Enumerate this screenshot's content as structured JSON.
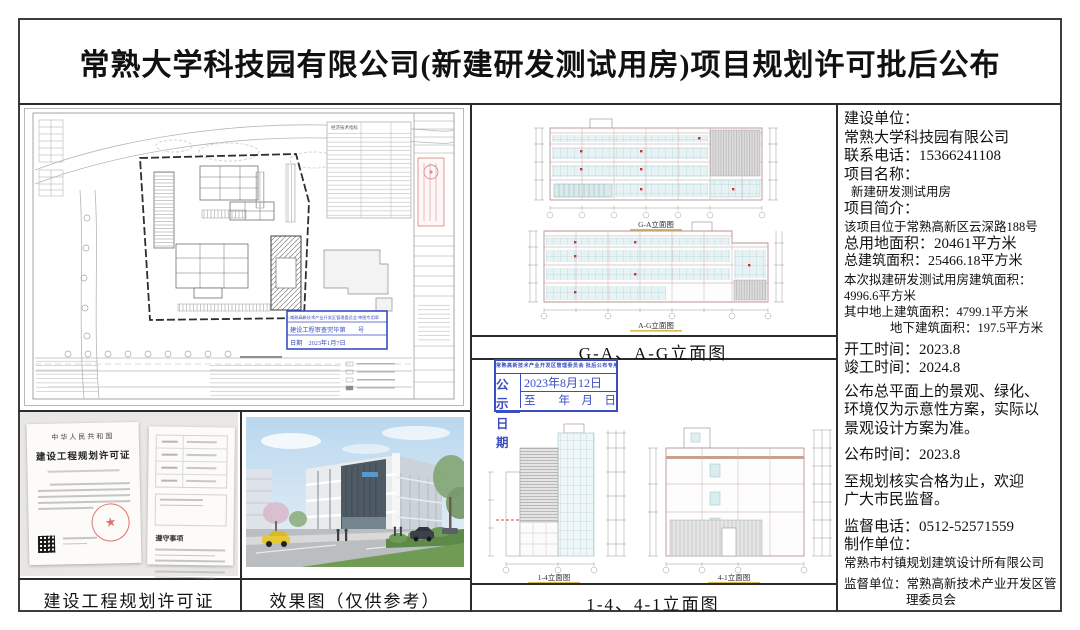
{
  "title": "常熟大学科技园有限公司(新建研发测试用房)项目规划许可批后公布",
  "captions": {
    "permit": "建设工程规划许可证",
    "render": "效果图（仅供参考）",
    "elevation_top": "G-A、A-G立面图",
    "elevation_bottom": "1-4、4-1立面图"
  },
  "elevation_sublabels": {
    "ga": "G-A立面图",
    "ag": "A-G立面图",
    "one_four": "1-4立面图",
    "four_one": "4-1立面图"
  },
  "info_panel": {
    "lines": [
      "建设单位：",
      "常熟大学科技园有限公司",
      "联系电话：15366241108",
      "项目名称：",
      "新建研发测试用房",
      "项目简介：",
      "该项目位于常熟高新区云深路188号",
      "总用地面积：20461平方米",
      "总建筑面积：25466.18平方米",
      "本次拟建研发测试用房建筑面积：",
      "4996.6平方米",
      "其中地上建筑面积：4799.1平方米",
      "地下建筑面积：197.5平方米",
      "开工时间：2023.8",
      "竣工时间：2024.8",
      "公布总平面上的景观、绿化、",
      "环境仅为示意性方案，实际以",
      "景观设计方案为准。",
      "公布时间：2023.8",
      "至规划核实合格为止，欢迎",
      "广大市民监督。",
      "监督电话：0512-52571559",
      "制作单位：",
      "常熟市村镇规划建筑设计所有限公司",
      "监督单位：常熟高新技术产业开发区管",
      "理委员会"
    ]
  },
  "publish_stamp": {
    "header": "常熟高新技术产业开发区管理委员会 批后公布专用章",
    "label_top": "公 示",
    "label_bottom": "日 期",
    "value_top": "2023年8月12日",
    "value_bottom": "至　　年　月　日"
  },
  "review_stamp": {
    "line1": "常熟高新技术产业开发区管理委员会 审图专用章",
    "line2": "建设工程审查完毕第　　号",
    "line3": "日期　2023年1月7日"
  },
  "permit_doc": {
    "nation": "中华人民共和国",
    "title": "建设工程规划许可证",
    "notes_title": "遵守事项",
    "seal_star": "★"
  },
  "site_plan": {
    "table_title": "经济技术指标"
  },
  "colors": {
    "stamp_blue": "#3a4ec2",
    "seal_red": "#d65c5c",
    "axis_red": "#b59494",
    "window_teal": "#9cc3ca",
    "caption_gold": "#d8b94e"
  }
}
